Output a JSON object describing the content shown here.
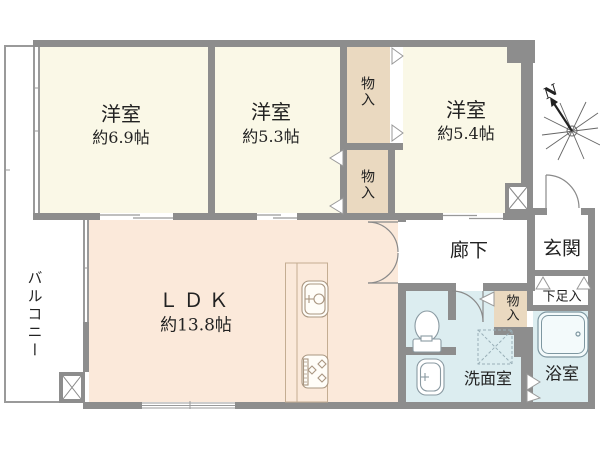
{
  "compass": {
    "north_label": "N"
  },
  "rooms": {
    "bedroom_west": {
      "label": "洋室",
      "size": "約6.9帖"
    },
    "bedroom_center": {
      "label": "洋室",
      "size": "約5.3帖"
    },
    "bedroom_east": {
      "label": "洋室",
      "size": "約5.4帖"
    },
    "ldk": {
      "label": "ＬＤＫ",
      "size": "約13.8帖"
    },
    "hallway": {
      "label": "廊下"
    },
    "entrance": {
      "label": "玄関"
    },
    "shoe_cabinet": {
      "label": "下足入"
    },
    "washroom": {
      "label": "洗面室"
    },
    "bathroom": {
      "label": "浴室"
    },
    "balcony": {
      "label": "バルコニー"
    },
    "closet_north": {
      "label": "物入"
    },
    "closet_center": {
      "label": "物入"
    },
    "closet_hall": {
      "label": "物入"
    }
  },
  "colors": {
    "wall": "#8d8d8d",
    "bedroom_floor": "#faf8e7",
    "ldk_floor": "#fbe9da",
    "closet_floor": "#ead9c0",
    "wet_area_floor": "#dcedf0",
    "balcony_outline": "#9a9a9a"
  }
}
